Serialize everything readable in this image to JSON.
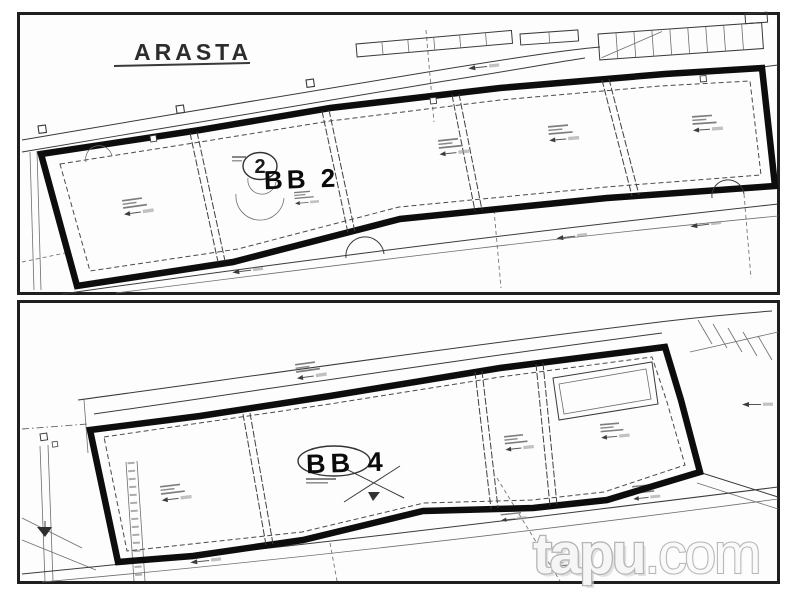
{
  "colors": {
    "background": "#ffffff",
    "paper": "#fdfdfd",
    "ink": "#1a1a1a",
    "boundary": "#0d0d0d",
    "watermark_gray": "#b5b5b5"
  },
  "top_plan": {
    "area_label": "ARASTA",
    "block_label": "BB 2",
    "parcel_number": "2"
  },
  "bottom_plan": {
    "block_label": "BB 4"
  },
  "watermark": {
    "brand": "tapu",
    "tld": ".com"
  }
}
